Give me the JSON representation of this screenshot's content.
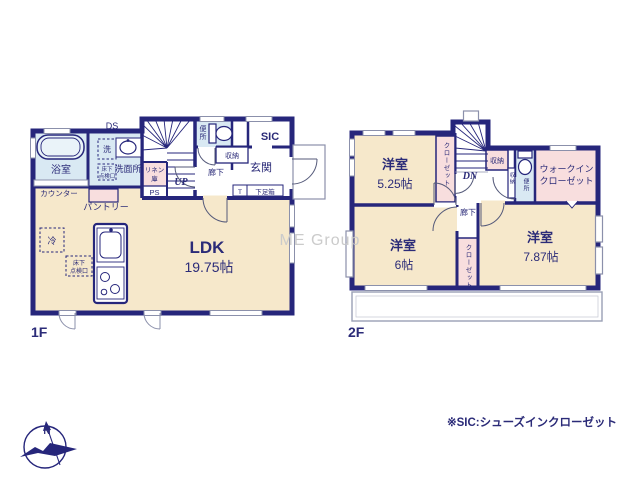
{
  "colors": {
    "wall": "#26267b",
    "room_floor": "#f6e8cb",
    "wet_area": "#d9e9f3",
    "closet": "#f8dede",
    "thin_line": "#8b90ab",
    "watermark": "#cbcbcb"
  },
  "watermark": "ME Group",
  "footnote": "※SIC:シューズインクローゼット",
  "compass_north": "N",
  "floor1": {
    "label": "1F",
    "bath": "浴室",
    "ds": "DS",
    "laundry": "洗",
    "washroom": "洗面所",
    "underfloor_top": "床下",
    "underfloor_bottom": "点検口",
    "linen_top": "リネン",
    "linen_bottom": "庫",
    "ps": "PS",
    "up": "UP",
    "toilet": "便所",
    "storage": "収納",
    "hallway": "廊下",
    "sic": "SIC",
    "entrance": "玄関",
    "t": "T",
    "shoebox": "下足箱",
    "counter": "カウンター",
    "pantry": "パントリー",
    "fridge": "冷",
    "ldk": "LDK",
    "ldk_size": "19.75帖"
  },
  "floor2": {
    "label": "2F",
    "bedroom1": "洋室",
    "bedroom1_size": "5.25帖",
    "closet1": "クローゼット",
    "dn": "DN",
    "storage1": "収納",
    "storage2": "収納",
    "toilet": "便所",
    "wic_line1": "ウォークイン",
    "wic_line2": "クローゼット",
    "hallway": "廊下",
    "bedroom2": "洋室",
    "bedroom2_size": "6帖",
    "closet2": "クローゼット",
    "bedroom3": "洋室",
    "bedroom3_size": "7.87帖"
  }
}
